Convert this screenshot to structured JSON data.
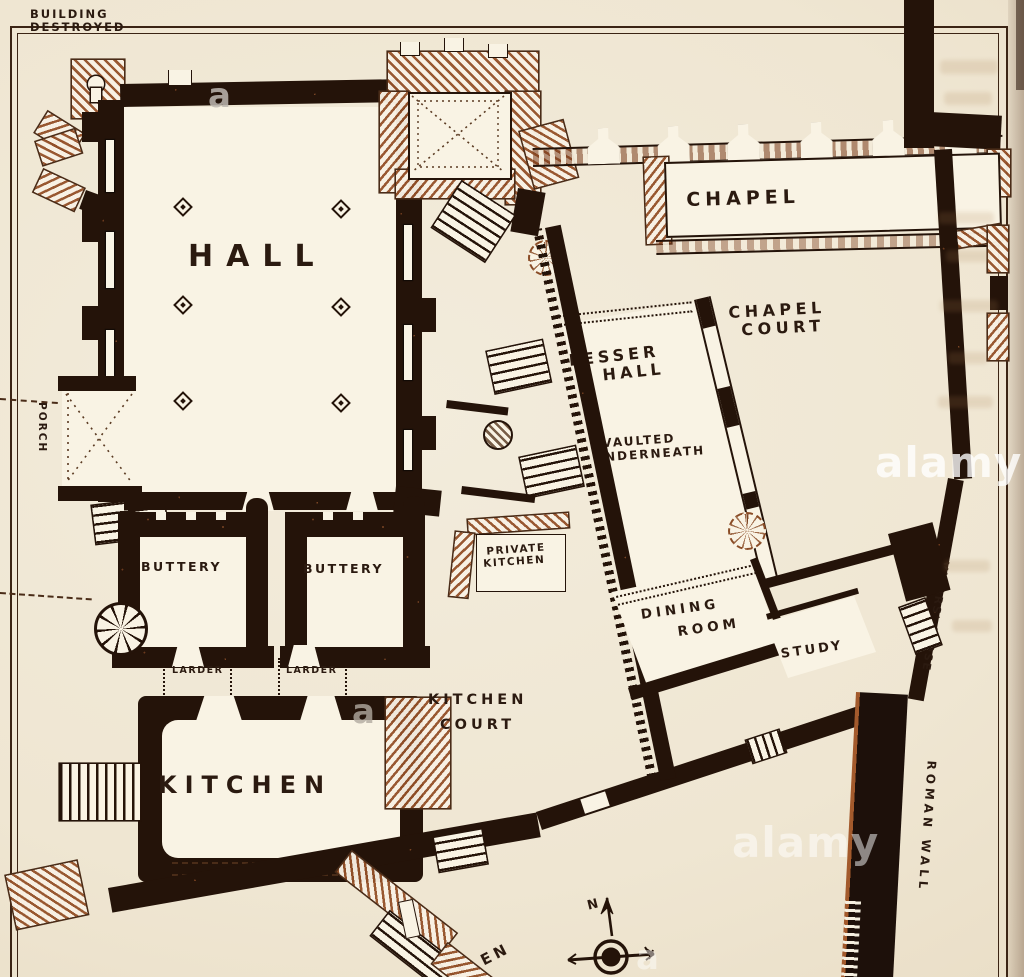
{
  "labels": {
    "building_destroyed": [
      "BUILDING",
      "DESTROYED"
    ],
    "hall": "HALL",
    "porch": "PORCH",
    "chapel": "CHAPEL",
    "chapel_court": [
      "CHAPEL",
      "COURT"
    ],
    "lesser_hall": [
      "LESSER",
      "HALL"
    ],
    "lesser_hall_note": [
      "VAULTED",
      "UNDERNEATH"
    ],
    "buttery_west": "BUTTERY",
    "buttery_east": "BUTTERY",
    "larder_west": "LARDER",
    "larder_east": "LARDER",
    "kitchen": "KITCHEN",
    "kitchen_court": [
      "KITCHEN",
      "COURT"
    ],
    "private_kitchen": [
      "PRIVATE",
      "KITCHEN"
    ],
    "dining_room": [
      "DINING",
      "ROOM"
    ],
    "study": "STUDY",
    "vicars_close": "VICARS' CLOSE",
    "roman_wall": "ROMAN WALL",
    "compass_north": "N",
    "partial_word_bottom": "EN"
  },
  "watermarks": {
    "alamy_right": "alamy",
    "alamy_bottom": "alamy",
    "partial_a_top": "a",
    "partial_a_kitchen": "a",
    "partial_a_compass": "a"
  },
  "colors": {
    "paper": "#efe6d2",
    "paper_light": "#f5eedd",
    "room": "#f9f3e4",
    "ink": "#241309",
    "ink_soft": "#4a2c18",
    "sepia": "#9a5a30",
    "label": "#2b1a10"
  }
}
